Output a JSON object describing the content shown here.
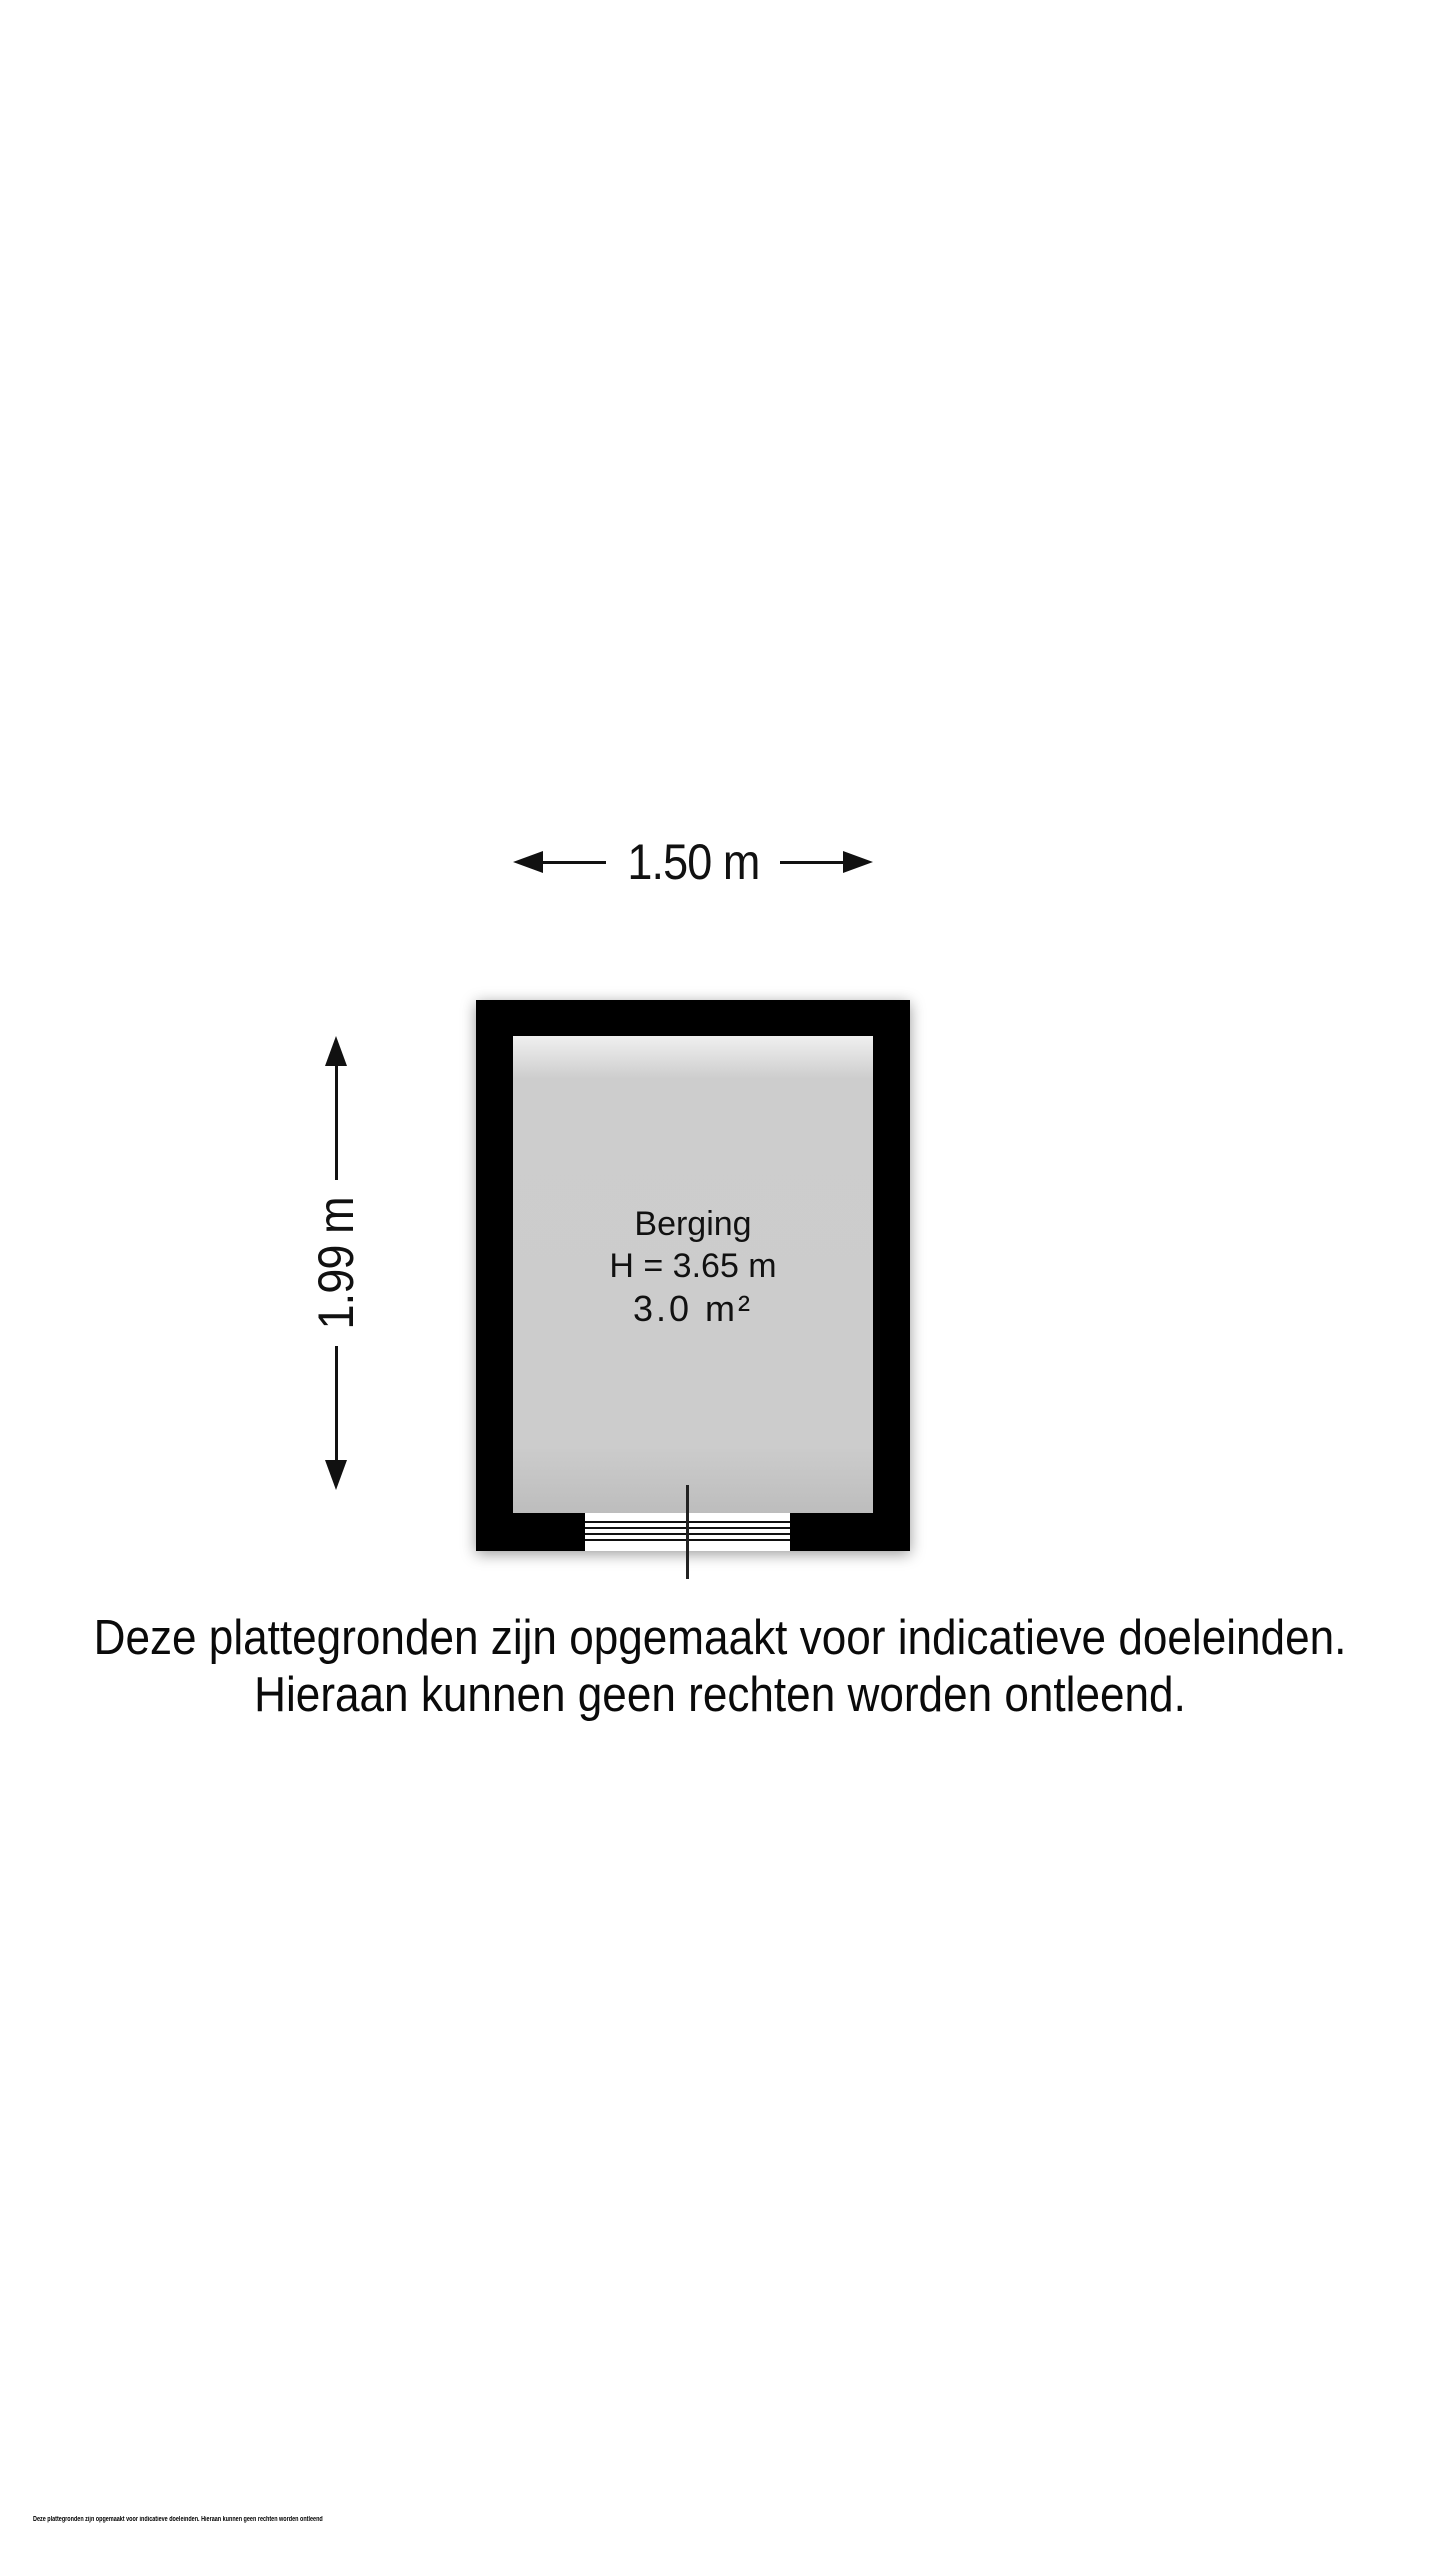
{
  "floorplan": {
    "room": {
      "name": "Berging",
      "ceiling_height_label": "H = 3.65 m",
      "area_label": "3.0 m²"
    },
    "dimensions": {
      "width_label": "1.50 m",
      "height_label": "1.99 m"
    },
    "colors": {
      "wall": "#000000",
      "floor": "#cdcdcd",
      "background": "#ffffff"
    }
  },
  "disclaimer": {
    "line1": "Deze plattegronden zijn opgemaakt voor indicatieve doeleinden.",
    "line2": "Hieraan kunnen geen rechten worden ontleend."
  },
  "footer": {
    "small_print": "Deze plattegronden zijn opgemaakt voor indicatieve doeleinden. Hieraan kunnen geen rechten worden ontleend"
  }
}
